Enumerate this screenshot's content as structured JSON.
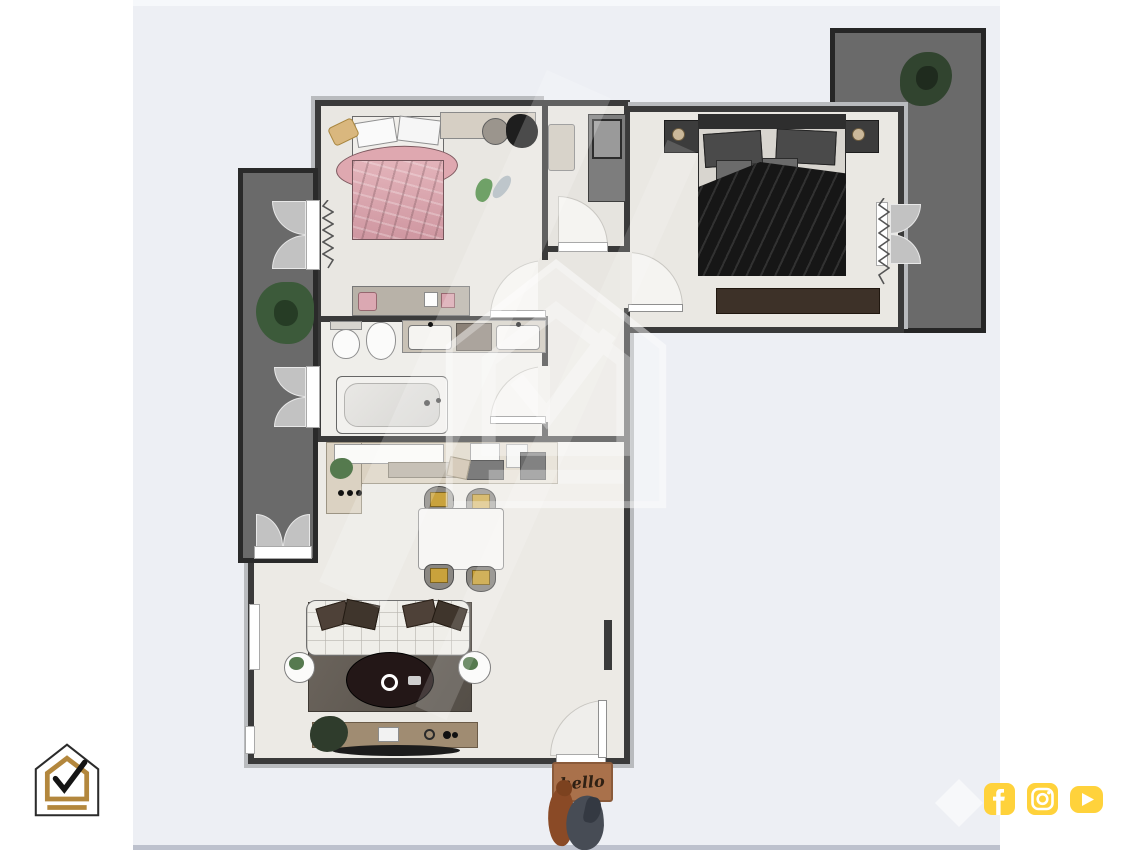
{
  "page": {
    "background_color": "#ffffff",
    "panel_color": "#edeff4",
    "panel_bottom_strip_color": "#bdc1cd"
  },
  "branding": {
    "corner_logo": {
      "name": "house-check-logo",
      "outline_color": "#2b2b2b",
      "accent_color": "#b3873d",
      "check_color": "#141414"
    },
    "center_watermark": {
      "name": "house-check-watermark",
      "color": "rgba(255,255,255,0.5)"
    },
    "diamond_watermark": {
      "name": "diamond-mark"
    },
    "social": {
      "button_color": "#ffd23b",
      "glyph_color": "#ffffff",
      "icons": [
        {
          "name": "facebook-icon"
        },
        {
          "name": "instagram-icon"
        },
        {
          "name": "youtube-icon"
        }
      ]
    }
  },
  "doormat": {
    "text": "hello",
    "mat_color": "#a9714b",
    "text_color": "#2f2013",
    "pets": [
      "brown-dog",
      "gray-dog"
    ]
  },
  "floorplan": {
    "colors": {
      "wall": "#3a3a3a",
      "wall_outer_band": "#b9bbbe",
      "floor": "#e9e7e2",
      "balcony": "#6a6a6a",
      "bed_pink": "#dca8b2",
      "bed_master_blanket": "#161616",
      "chair_cushion_gold": "#c9a23c",
      "rug_gray": "#655e56",
      "console_wood": "#a08c72"
    },
    "rooms": [
      {
        "name": "bedroom-small",
        "furniture": [
          "pink-bed",
          "pillows",
          "desk",
          "desk-chair",
          "dark-plant",
          "green-slippers",
          "dresser",
          "pink-stool",
          "storage-boxes"
        ]
      },
      {
        "name": "closet-room",
        "furniture": [
          "beige-cabinet",
          "wardrobe-unit"
        ]
      },
      {
        "name": "bedroom-master",
        "furniture": [
          "double-bed",
          "black-blanket",
          "nightstand-left",
          "nightstand-right",
          "bench-rug",
          "curtains"
        ]
      },
      {
        "name": "bathroom",
        "furniture": [
          "toilet",
          "bidet",
          "vanity-double-sink",
          "bathtub"
        ]
      },
      {
        "name": "hallway",
        "furniture": [
          "radiator"
        ]
      },
      {
        "name": "living-kitchen",
        "furniture": [
          "kitchen-counter",
          "stove-burners",
          "kitchen-plant",
          "cutting-board",
          "appliances",
          "dining-table",
          "dining-chairs-gold-x4",
          "sofa-white-tufted",
          "throw-pillows",
          "area-rug",
          "oval-coffee-table",
          "side-table-left",
          "side-table-right",
          "tv-console",
          "tv",
          "console-plant"
        ]
      },
      {
        "name": "balcony-left",
        "furniture": [
          "large-plant",
          "french-doors-x3"
        ]
      },
      {
        "name": "terrace-top-right",
        "furniture": [
          "plant",
          "french-door"
        ]
      }
    ],
    "doors": [
      "entry-door-bottom",
      "bedroom-small-door",
      "bathroom-door",
      "closet-door",
      "master-bedroom-door",
      "terrace-door",
      "balcony-doors"
    ]
  }
}
